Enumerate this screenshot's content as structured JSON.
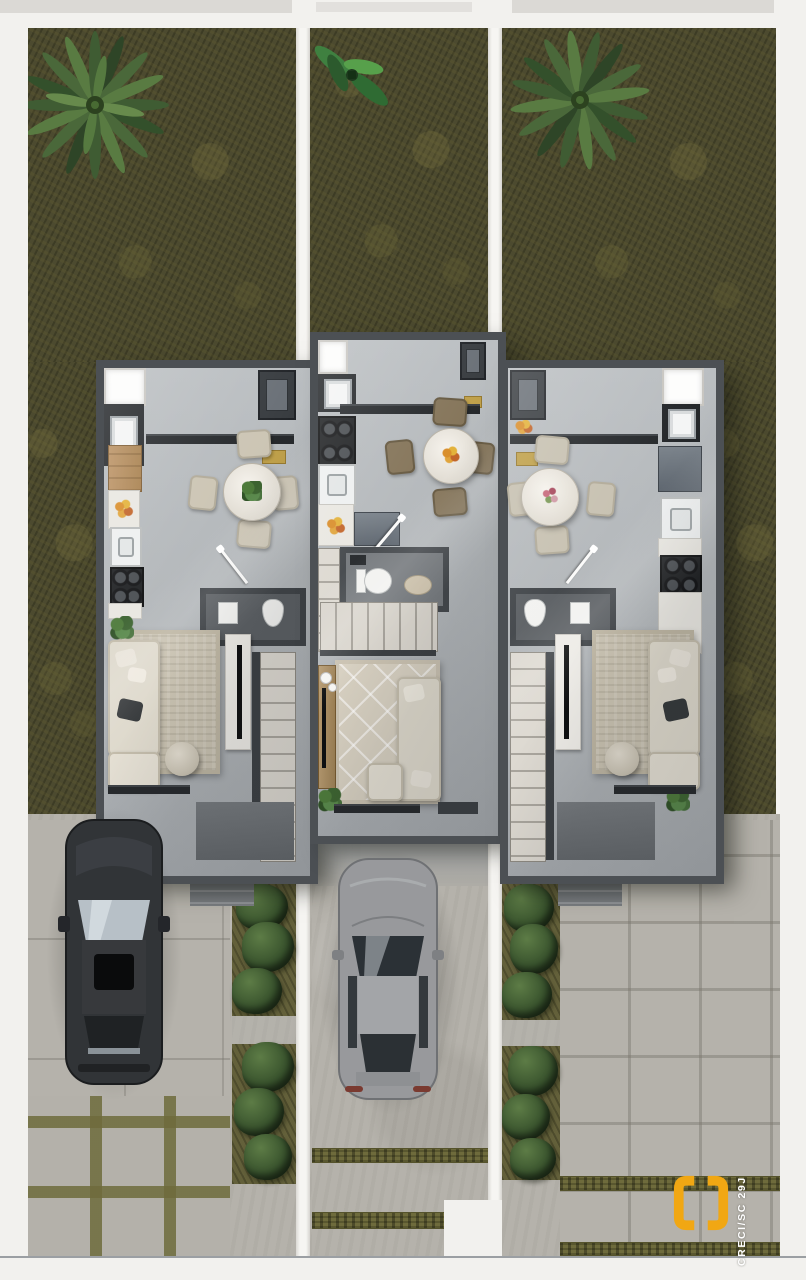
{
  "watermark": {
    "text": "CRECI/SC 29J"
  },
  "palette": {
    "accent": "#F1A713",
    "grass": "#4C4A2F",
    "wall": "#4C5054",
    "paving": "#B5B2AB",
    "joint": "#6E6B3C",
    "sofa": "#DED9CC",
    "divider": "#F3F2EE",
    "suv_body": "#313437",
    "sedan_body": "#98999C"
  },
  "scene": {
    "type": "top-down 3D architectural floor plan render",
    "units": [
      {
        "id": "left",
        "rooms": [
          "kitchen",
          "dining area",
          "powder room",
          "living room",
          "staircase",
          "entry"
        ],
        "dining_seats": 4,
        "driveway": "dark gray SUV parked"
      },
      {
        "id": "center",
        "rooms": [
          "kitchen",
          "dining area",
          "bathroom",
          "staircase",
          "living room",
          "entry"
        ],
        "dining_seats": 4,
        "driveway": "silver sedan parked"
      },
      {
        "id": "right",
        "rooms": [
          "kitchen",
          "dining area",
          "powder room",
          "living room",
          "staircase",
          "entry"
        ],
        "dining_seats": 4,
        "driveway": "empty"
      }
    ],
    "landscape": {
      "palm_trees": 2,
      "tropical_plants": 1,
      "hedge_strips": 2
    }
  }
}
